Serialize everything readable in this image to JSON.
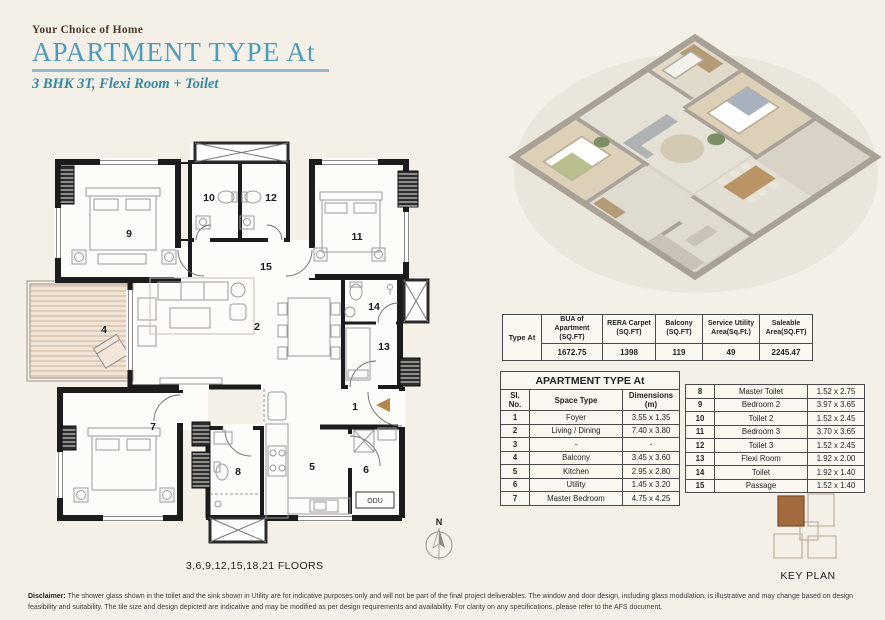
{
  "header": {
    "tagline": "Your Choice of Home",
    "title": "APARTMENT TYPE At",
    "subtitle": "3 BHK 3T, Flexi Room + Toilet",
    "accent_teal": "#4f9cba",
    "accent_brown": "#4d3b2b"
  },
  "summary_table": {
    "type_label": "Type At",
    "columns": [
      "BUA of Apartment (SQ.FT)",
      "RERA Carpet (SQ.FT)",
      "Balcony (SQ.FT)",
      "Service Utility Area(Sq.Ft.)",
      "Saleable Area(SQ.FT)"
    ],
    "values": [
      "1672.75",
      "1398",
      "119",
      "49",
      "2245.47"
    ]
  },
  "dimensions_table": {
    "title": "APARTMENT TYPE At",
    "columns": [
      "Sl. No.",
      "Space Type",
      "Dimensions (m)"
    ],
    "rows": [
      {
        "no": "1",
        "space": "Foyer",
        "dim": "3.55 x 1.35"
      },
      {
        "no": "2",
        "space": "Living / Dining",
        "dim": "7.40 x 3.80"
      },
      {
        "no": "3",
        "space": "-",
        "dim": "-"
      },
      {
        "no": "4",
        "space": "Balcony",
        "dim": "3.45 x 3.60"
      },
      {
        "no": "5",
        "space": "Kitchen",
        "dim": "2.95 x 2.80"
      },
      {
        "no": "6",
        "space": "Utility",
        "dim": "1.45 x 3.20"
      },
      {
        "no": "7",
        "space": "Master Bedroom",
        "dim": "4.75 x 4.25"
      },
      {
        "no": "8",
        "space": "Master Toilet",
        "dim": "1.52 x 2.75"
      },
      {
        "no": "9",
        "space": "Bedroom 2",
        "dim": "3.97 x 3.65"
      },
      {
        "no": "10",
        "space": "Toilet 2",
        "dim": "1.52 x 2.45"
      },
      {
        "no": "11",
        "space": "Bedroom 3",
        "dim": "3.70 x 3.65"
      },
      {
        "no": "12",
        "space": "Toilet 3",
        "dim": "1.52 x 2.45"
      },
      {
        "no": "13",
        "space": "Flexi Room",
        "dim": "1.92 x 2.00"
      },
      {
        "no": "14",
        "space": "Toilet",
        "dim": "1.92 x 1.40"
      },
      {
        "no": "15",
        "space": "Passage",
        "dim": "1.52 x 1.40"
      }
    ]
  },
  "floor_plan": {
    "room_numbers": [
      "1",
      "2",
      "3",
      "4",
      "5",
      "6",
      "7",
      "8",
      "9",
      "10",
      "11",
      "12",
      "13",
      "14",
      "15"
    ],
    "odu_label": "ODU",
    "floors_label": "3,6,9,12,15,18,21 FLOORS",
    "compass_north": "N",
    "entry_arrow_color": "#b5854a"
  },
  "key_plan": {
    "label": "KEY PLAN",
    "highlight_color": "#a26a3f"
  },
  "disclaimer": {
    "label": "Disclaimer:",
    "text": " The shower glass shown in the toilet and the sink shown in Utility are for indicative purposes only and will not be part of the final project deliverables. The window and door design, including glass modulation, is illustrative and may change based on design feasibility and suitability. The tile size and design depicted are indicative and may be modified as per design requirements and availability. For clarity on any specifications, please refer to the AFS document."
  }
}
